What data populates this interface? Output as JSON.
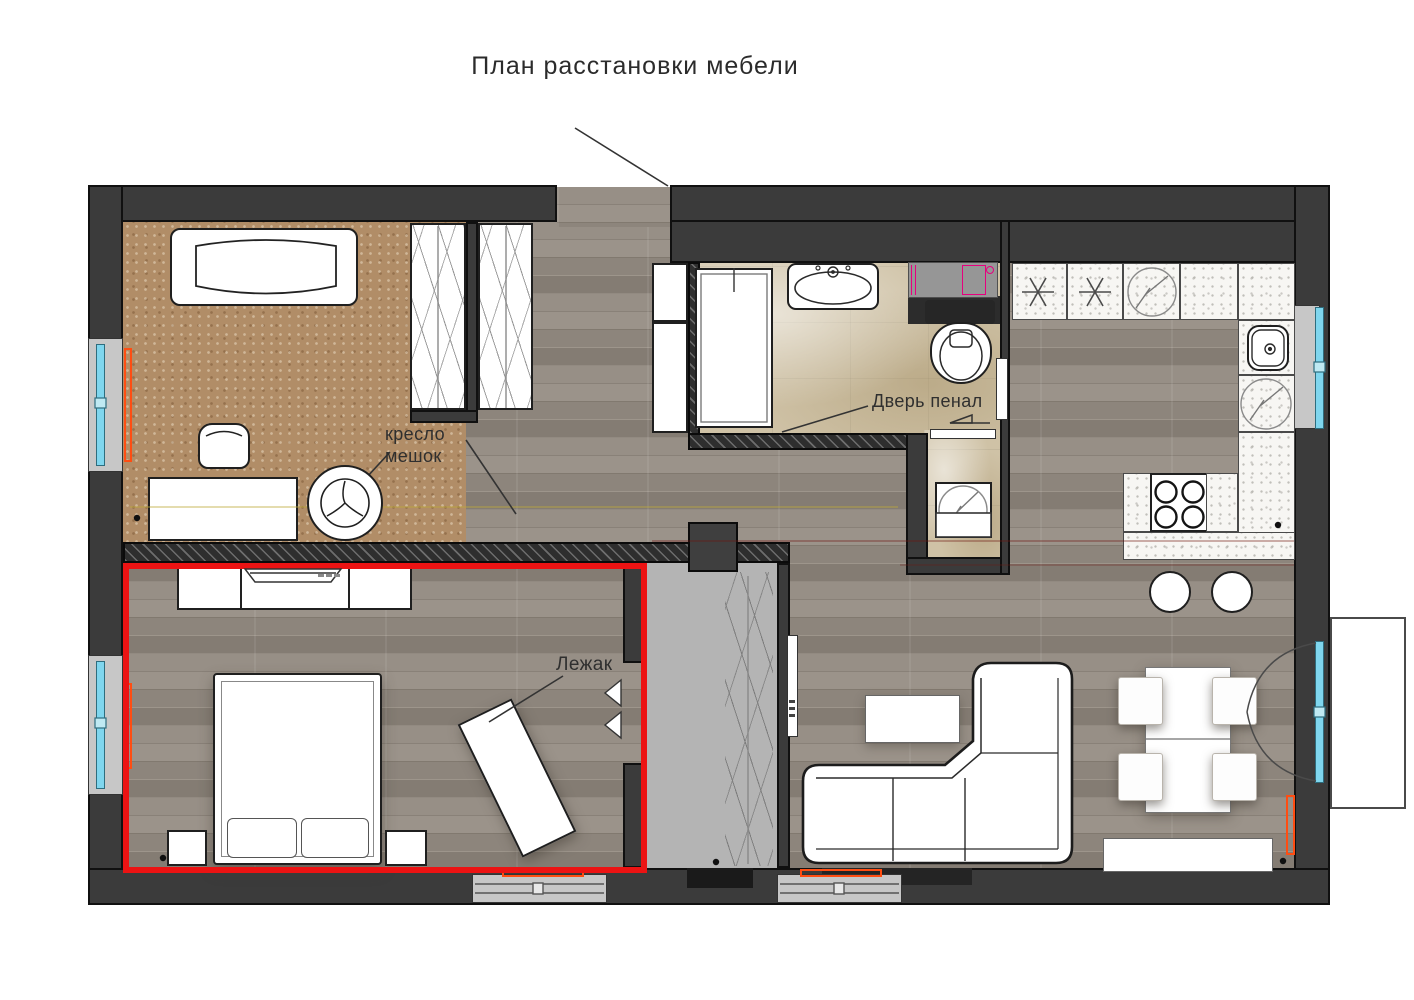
{
  "title": "План расстановки мебели",
  "annotations": {
    "bean_bag_line1": "кресло",
    "bean_bag_line2": "мешок",
    "pocket_door": "Дверь пенал",
    "lounger": "Лежак"
  },
  "colors": {
    "wall": "#3b3b3b",
    "cork_floor": "#b18d67",
    "wood_floor": "#8f887f",
    "tile_floor": "#cfc2a6",
    "counter": "#f7f6f3",
    "closet_floor": "#b4b4b4",
    "highlight_red": "#ec1313",
    "window_glass": "#7fd6ee",
    "radiator_orange": "#ff4d12",
    "plumbing_magenta": "#e6007e"
  }
}
